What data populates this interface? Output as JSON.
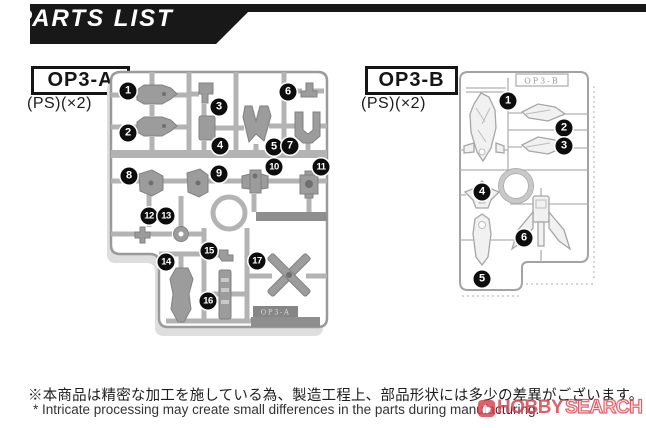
{
  "header": {
    "title": "PARTS LIST"
  },
  "runners": [
    {
      "label": "OP3-A",
      "material": "(PS)(×2)",
      "molded_tag": "OP3-A",
      "style": "gray-molded",
      "callouts": [
        {
          "n": "1",
          "x": 24,
          "y": 27
        },
        {
          "n": "2",
          "x": 24,
          "y": 69
        },
        {
          "n": "3",
          "x": 115,
          "y": 43
        },
        {
          "n": "4",
          "x": 116,
          "y": 82
        },
        {
          "n": "5",
          "x": 170,
          "y": 83
        },
        {
          "n": "6",
          "x": 184,
          "y": 28
        },
        {
          "n": "7",
          "x": 186,
          "y": 82
        },
        {
          "n": "8",
          "x": 25,
          "y": 112
        },
        {
          "n": "9",
          "x": 115,
          "y": 110
        },
        {
          "n": "10",
          "x": 170,
          "y": 103
        },
        {
          "n": "11",
          "x": 217,
          "y": 103
        },
        {
          "n": "12",
          "x": 45,
          "y": 152
        },
        {
          "n": "13",
          "x": 62,
          "y": 152
        },
        {
          "n": "14",
          "x": 62,
          "y": 198
        },
        {
          "n": "15",
          "x": 105,
          "y": 187
        },
        {
          "n": "16",
          "x": 104,
          "y": 237
        },
        {
          "n": "17",
          "x": 153,
          "y": 197
        }
      ]
    },
    {
      "label": "OP3-B",
      "material": "(PS)(×2)",
      "molded_tag": "OP3-B",
      "style": "clear-outline",
      "callouts": [
        {
          "n": "1",
          "x": 56,
          "y": 37
        },
        {
          "n": "2",
          "x": 112,
          "y": 64
        },
        {
          "n": "3",
          "x": 112,
          "y": 82
        },
        {
          "n": "4",
          "x": 30,
          "y": 128
        },
        {
          "n": "5",
          "x": 30,
          "y": 215
        },
        {
          "n": "6",
          "x": 72,
          "y": 174
        }
      ]
    }
  ],
  "notes": {
    "jp": "※本商品は精密な加工を施している為、製造工程上、部品形状には多少の差異がございます。",
    "en": "* Intricate processing may create small differences in the parts during manufacturing."
  },
  "watermark": {
    "brand_bold": "HOBBY",
    "brand_outline": "SEARCH",
    "color": "#d6404d"
  },
  "colors": {
    "banner": "#181818",
    "sprue_rail": "#b3b3b3",
    "part_gray": "#9c9c9c",
    "dark_bar": "#8e8e8e",
    "outline_gray": "#a8a8a8"
  }
}
